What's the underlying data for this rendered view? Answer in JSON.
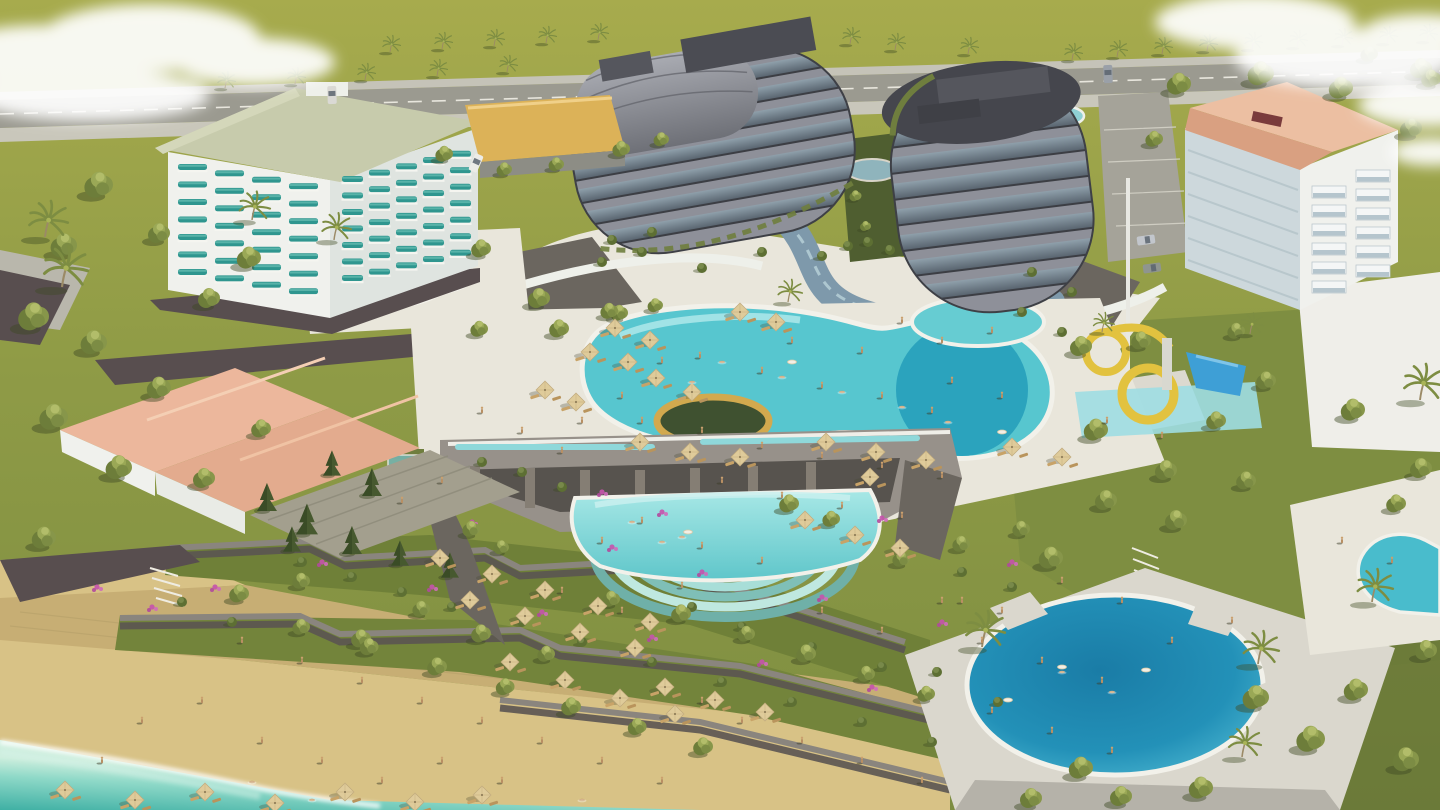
{
  "meta": {
    "title": "Aerial 3D architectural rendering of a seaside resort complex",
    "type": "architectural-visualization",
    "landmarks": [
      "white-hotel-teal-balconies",
      "curved-tower-west",
      "curved-tower-east",
      "salmon-roof-apartment",
      "salmon-roof-villa",
      "main-lagoon-pool",
      "kids-pool",
      "waterslides",
      "infinity-cascade-pool",
      "circular-pool",
      "kidney-pool",
      "right-edge-pool",
      "beach",
      "sea",
      "terraced-gardens",
      "palm-boulevard"
    ]
  },
  "colors": {
    "grass_far": "#a7ab4d",
    "grass_mid": "#8f9b46",
    "grass_near": "#7d8d41",
    "grass_shade": "#5e7034",
    "road": "#9b9a90",
    "sidewalk": "#c9c7bb",
    "parking": "#a5a399",
    "paving": "#e9e6db",
    "paving_shade": "#cfccc2",
    "deck": "#dad7cd",
    "sand": "#d8c286",
    "pavers": "#c7ae74",
    "sea_light": "#cdeedd",
    "sea_deep": "#3fb0a4",
    "foam": "#ffffff",
    "pool_main": "#57c6cf",
    "pool_deep": "#2ba3bd",
    "pool_light": "#8fd3e2",
    "pool_infinity": "#6fcdd0",
    "pool_round_deep": "#1a7ca6",
    "pool_round_edge": "#45b0cc",
    "lagoon": "#7e99ab",
    "wall_dark": "#584e4f",
    "wall_grey": "#8a857e",
    "stone": "#97918a",
    "stone_dark": "#6b665f",
    "white_bldg": "#f0f1ed",
    "white_shade": "#dfe4e0",
    "plaza": "#efeee9",
    "teal_balcony": "#2f968f",
    "roof_sage": "#c7cbac",
    "roof_salmon": "#e3ad8e",
    "roof_salmon_light": "#ecbfa2",
    "roof_salmon_dark": "#d9a081",
    "roof_shingle": "#a39f8e",
    "tower_band": "#8e9099",
    "tower_dark": "#45464d",
    "tower_glass_hi": "#8fa0ab",
    "tower_glass_lo": "#56616c",
    "slide_yellow": "#e2c23f",
    "slide_blue": "#3e9fd6",
    "umbrella": "#dfcb9a",
    "umbrella_edge": "#bfa97c",
    "lounger": "#c8a368",
    "tree_dark": "#6d7d3a",
    "tree_mid": "#87964a",
    "tree_light": "#9aa856",
    "pine": "#47592f",
    "palm_frond": "#7d8d42",
    "trunk": "#9b8a66",
    "bougainvillea": "#c653ad",
    "gold_ring": "#d2a94e",
    "yellow_roof": "#dcb258",
    "cloud": "#ffffff"
  },
  "scene": {
    "palms_far": [
      [
        225,
        88
      ],
      [
        295,
        84
      ],
      [
        365,
        80
      ],
      [
        437,
        76
      ],
      [
        507,
        72
      ],
      [
        390,
        52
      ],
      [
        442,
        49
      ],
      [
        494,
        46
      ],
      [
        546,
        43
      ],
      [
        598,
        40
      ],
      [
        850,
        44
      ],
      [
        895,
        50
      ],
      [
        968,
        54
      ],
      [
        1072,
        60
      ],
      [
        1117,
        57
      ],
      [
        1162,
        54
      ],
      [
        1207,
        51
      ],
      [
        1252,
        49
      ],
      [
        1297,
        47
      ],
      [
        1342,
        45
      ],
      [
        1387,
        43
      ],
      [
        1427,
        41
      ]
    ],
    "palms": [
      [
        45,
        237,
        1.2
      ],
      [
        252,
        220,
        0.95
      ],
      [
        334,
        240,
        0.9
      ],
      [
        62,
        287,
        1.35
      ],
      [
        982,
        647,
        1.2
      ],
      [
        1258,
        664,
        1.1
      ],
      [
        1242,
        757,
        1.0
      ],
      [
        1420,
        400,
        1.2
      ],
      [
        1372,
        602,
        1.1
      ],
      [
        788,
        302,
        0.75
      ],
      [
        1250,
        334,
        0.7
      ],
      [
        1102,
        332,
        0.65
      ]
    ],
    "trees": [
      [
        100,
        190,
        1.3
      ],
      [
        65,
        250,
        1.2
      ],
      [
        160,
        237,
        1.0
      ],
      [
        250,
        262,
        1.1
      ],
      [
        210,
        302,
        1.0
      ],
      [
        35,
        322,
        1.4
      ],
      [
        95,
        347,
        1.2
      ],
      [
        160,
        392,
        1.1
      ],
      [
        55,
        422,
        1.3
      ],
      [
        120,
        472,
        1.2
      ],
      [
        45,
        542,
        1.1
      ],
      [
        205,
        482,
        1.0
      ],
      [
        262,
        432,
        0.9
      ],
      [
        482,
        252,
        0.9
      ],
      [
        540,
        302,
        1.0
      ],
      [
        480,
        332,
        0.8
      ],
      [
        620,
        316,
        0.8
      ],
      [
        656,
        308,
        0.7
      ],
      [
        560,
        332,
        0.9
      ],
      [
        610,
        314,
        0.8
      ],
      [
        445,
        157,
        0.8
      ],
      [
        505,
        172,
        0.7
      ],
      [
        557,
        167,
        0.7
      ],
      [
        622,
        152,
        0.8
      ],
      [
        662,
        142,
        0.7
      ],
      [
        1180,
        88,
        1.1
      ],
      [
        1262,
        78,
        1.2
      ],
      [
        1342,
        92,
        1.1
      ],
      [
        1422,
        72,
        1.0
      ],
      [
        1370,
        57,
        0.8
      ],
      [
        1432,
        82,
        0.9
      ],
      [
        1412,
        132,
        1.0
      ],
      [
        1155,
        142,
        0.8
      ],
      [
        856,
        198,
        0.55
      ],
      [
        866,
        228,
        0.5
      ],
      [
        1082,
        350,
        1.0
      ],
      [
        1142,
        344,
        0.9
      ],
      [
        1097,
        434,
        1.1
      ],
      [
        1167,
        474,
        1.0
      ],
      [
        1217,
        424,
        0.9
      ],
      [
        1267,
        384,
        0.9
      ],
      [
        1237,
        334,
        0.8
      ],
      [
        1052,
        562,
        1.1
      ],
      [
        1107,
        504,
        1.0
      ],
      [
        1177,
        524,
        1.0
      ],
      [
        1247,
        484,
        0.9
      ],
      [
        1354,
        414,
        1.1
      ],
      [
        1422,
        472,
        1.0
      ],
      [
        1397,
        507,
        0.9
      ],
      [
        240,
        597,
        0.9
      ],
      [
        302,
        584,
        0.8
      ],
      [
        362,
        642,
        0.9
      ],
      [
        422,
        612,
        0.8
      ],
      [
        482,
        637,
        0.9
      ],
      [
        547,
        657,
        0.8
      ],
      [
        612,
        602,
        0.8
      ],
      [
        682,
        617,
        0.9
      ],
      [
        747,
        637,
        0.8
      ],
      [
        807,
        657,
        0.9
      ],
      [
        867,
        677,
        0.8
      ],
      [
        927,
        697,
        0.8
      ],
      [
        302,
        630,
        0.8
      ],
      [
        370,
        650,
        0.85
      ],
      [
        438,
        670,
        0.9
      ],
      [
        506,
        690,
        0.85
      ],
      [
        572,
        710,
        0.9
      ],
      [
        638,
        730,
        0.85
      ],
      [
        704,
        750,
        0.9
      ],
      [
        1257,
        702,
        1.2
      ],
      [
        1312,
        744,
        1.3
      ],
      [
        1357,
        694,
        1.1
      ],
      [
        1407,
        764,
        1.2
      ],
      [
        1427,
        654,
        1.0
      ],
      [
        1202,
        792,
        1.1
      ],
      [
        1122,
        800,
        1.0
      ],
      [
        1082,
        772,
        1.1
      ],
      [
        1032,
        802,
        1.0
      ],
      [
        790,
        507,
        0.9
      ],
      [
        832,
        522,
        0.8
      ],
      [
        472,
        532,
        0.8
      ],
      [
        502,
        550,
        0.7
      ],
      [
        902,
        562,
        0.8
      ],
      [
        962,
        547,
        0.8
      ],
      [
        1022,
        532,
        0.8
      ]
    ],
    "pines": [
      [
        267,
        507,
        1.0
      ],
      [
        307,
        530,
        1.1
      ],
      [
        352,
        550,
        1.0
      ],
      [
        400,
        562,
        0.9
      ],
      [
        450,
        574,
        0.9
      ],
      [
        332,
        472,
        0.9
      ],
      [
        372,
        492,
        1.0
      ],
      [
        292,
        548,
        0.9
      ]
    ],
    "bushes": [
      [
        937,
        672
      ],
      [
        998,
        702
      ],
      [
        868,
        242
      ],
      [
        822,
        256
      ],
      [
        762,
        252
      ],
      [
        702,
        268
      ],
      [
        642,
        252
      ],
      [
        602,
        262
      ],
      [
        1022,
        312
      ],
      [
        1062,
        332
      ],
      [
        482,
        462
      ],
      [
        522,
        472
      ],
      [
        562,
        487
      ],
      [
        302,
        562
      ],
      [
        352,
        577
      ],
      [
        402,
        592
      ],
      [
        452,
        607
      ],
      [
        522,
        622
      ],
      [
        582,
        642
      ],
      [
        652,
        662
      ],
      [
        722,
        682
      ],
      [
        792,
        702
      ],
      [
        862,
        722
      ],
      [
        932,
        742
      ],
      [
        232,
        622
      ],
      [
        182,
        602
      ],
      [
        962,
        572
      ],
      [
        1012,
        587
      ],
      [
        692,
        607
      ],
      [
        742,
        627
      ],
      [
        812,
        647
      ],
      [
        882,
        667
      ],
      [
        652,
        232
      ],
      [
        612,
        240
      ],
      [
        1032,
        272
      ],
      [
        1072,
        292
      ],
      [
        848,
        246
      ],
      [
        890,
        250
      ]
    ],
    "bougainvillea": [
      [
        215,
        587
      ],
      [
        322,
        562
      ],
      [
        432,
        587
      ],
      [
        542,
        612
      ],
      [
        652,
        637
      ],
      [
        762,
        662
      ],
      [
        872,
        687
      ],
      [
        472,
        522
      ],
      [
        612,
        547
      ],
      [
        702,
        572
      ],
      [
        822,
        597
      ],
      [
        942,
        622
      ],
      [
        97,
        587
      ],
      [
        152,
        607
      ],
      [
        602,
        492
      ],
      [
        662,
        512
      ],
      [
        1012,
        562
      ],
      [
        882,
        518
      ]
    ],
    "umbrellas": [
      [
        740,
        312
      ],
      [
        776,
        322
      ],
      [
        615,
        328
      ],
      [
        650,
        340
      ],
      [
        628,
        362
      ],
      [
        590,
        352
      ],
      [
        545,
        390
      ],
      [
        576,
        402
      ],
      [
        656,
        378
      ],
      [
        692,
        392
      ],
      [
        640,
        442
      ],
      [
        690,
        452
      ],
      [
        740,
        457
      ],
      [
        826,
        442
      ],
      [
        876,
        452
      ],
      [
        926,
        460
      ],
      [
        1012,
        447
      ],
      [
        1062,
        457
      ],
      [
        440,
        558
      ],
      [
        492,
        574
      ],
      [
        545,
        590
      ],
      [
        598,
        606
      ],
      [
        650,
        622
      ],
      [
        470,
        600
      ],
      [
        525,
        616
      ],
      [
        580,
        632
      ],
      [
        635,
        648
      ],
      [
        510,
        662
      ],
      [
        565,
        680
      ],
      [
        620,
        698
      ],
      [
        675,
        714
      ],
      [
        805,
        520
      ],
      [
        855,
        535
      ],
      [
        900,
        548
      ],
      [
        870,
        477
      ],
      [
        665,
        687
      ],
      [
        715,
        700
      ],
      [
        765,
        712
      ],
      [
        65,
        790
      ],
      [
        135,
        800
      ],
      [
        205,
        792
      ],
      [
        275,
        803
      ],
      [
        345,
        792
      ],
      [
        415,
        802
      ],
      [
        482,
        795
      ]
    ],
    "people": [
      [
        700,
        357
      ],
      [
        762,
        372
      ],
      [
        822,
        387
      ],
      [
        882,
        397
      ],
      [
        932,
        412
      ],
      [
        862,
        352
      ],
      [
        792,
        342
      ],
      [
        952,
        382
      ],
      [
        1002,
        397
      ],
      [
        662,
        362
      ],
      [
        622,
        397
      ],
      [
        582,
        422
      ],
      [
        642,
        422
      ],
      [
        702,
        432
      ],
      [
        762,
        447
      ],
      [
        822,
        457
      ],
      [
        882,
        467
      ],
      [
        942,
        477
      ],
      [
        562,
        452
      ],
      [
        522,
        432
      ],
      [
        482,
        412
      ],
      [
        942,
        342
      ],
      [
        992,
        332
      ],
      [
        902,
        322
      ],
      [
        1107,
        422
      ],
      [
        1162,
        437
      ],
      [
        722,
        482
      ],
      [
        782,
        497
      ],
      [
        842,
        507
      ],
      [
        902,
        517
      ],
      [
        642,
        522
      ],
      [
        602,
        542
      ],
      [
        702,
        547
      ],
      [
        762,
        562
      ],
      [
        682,
        587
      ],
      [
        622,
        612
      ],
      [
        562,
        592
      ],
      [
        822,
        612
      ],
      [
        882,
        632
      ],
      [
        942,
        602
      ],
      [
        1002,
        612
      ],
      [
        1062,
        582
      ],
      [
        1122,
        602
      ],
      [
        982,
        642
      ],
      [
        1042,
        662
      ],
      [
        242,
        642
      ],
      [
        302,
        662
      ],
      [
        362,
        682
      ],
      [
        422,
        702
      ],
      [
        482,
        722
      ],
      [
        542,
        742
      ],
      [
        602,
        762
      ],
      [
        662,
        782
      ],
      [
        202,
        702
      ],
      [
        142,
        722
      ],
      [
        262,
        742
      ],
      [
        322,
        762
      ],
      [
        382,
        782
      ],
      [
        102,
        762
      ],
      [
        442,
        762
      ],
      [
        502,
        782
      ],
      [
        702,
        702
      ],
      [
        742,
        722
      ],
      [
        802,
        742
      ],
      [
        862,
        762
      ],
      [
        922,
        782
      ],
      [
        992,
        712
      ],
      [
        1052,
        732
      ],
      [
        1112,
        752
      ],
      [
        1172,
        642
      ],
      [
        1232,
        622
      ],
      [
        962,
        602
      ],
      [
        442,
        482
      ],
      [
        402,
        502
      ],
      [
        1342,
        542
      ],
      [
        1392,
        562
      ],
      [
        1102,
        682
      ]
    ],
    "swimmers": [
      [
        722,
        362
      ],
      [
        782,
        377
      ],
      [
        842,
        392
      ],
      [
        902,
        407
      ],
      [
        948,
        422
      ],
      [
        692,
        382
      ],
      [
        632,
        522
      ],
      [
        682,
        537
      ],
      [
        1062,
        672
      ],
      [
        1112,
        692
      ],
      [
        662,
        542
      ],
      [
        252,
        782
      ],
      [
        312,
        800
      ],
      [
        582,
        800
      ]
    ],
    "floats": [
      [
        792,
        362
      ],
      [
        1002,
        432
      ],
      [
        1062,
        667
      ],
      [
        1146,
        670
      ],
      [
        1008,
        700
      ],
      [
        688,
        532
      ]
    ],
    "cars": [
      [
        332,
        95,
        -2,
        "#dad9d4"
      ],
      [
        1108,
        74,
        -2,
        "#9aa0a8"
      ],
      [
        476,
        163,
        24,
        "#ecece8"
      ],
      [
        1146,
        240,
        82,
        "#c2c6cc"
      ],
      [
        1152,
        268,
        82,
        "#8f958f"
      ]
    ],
    "hotel_balconies": {
      "left": {
        "x": 178,
        "y": 164,
        "cols": 4,
        "rows": 7,
        "dx": 37,
        "dy": 17.5,
        "w": 29,
        "colSlant": 6.4
      },
      "right": {
        "x": 342,
        "y": 176,
        "cols": 5,
        "rows": 7,
        "dx": 27,
        "dy": 16.5,
        "w": 21,
        "colSlant": -6.3
      }
    },
    "apt_balconies": {
      "x": 1312,
      "y": 186,
      "cols": 2,
      "rows": 6,
      "dx": 44,
      "dy": 19,
      "w": 34,
      "colSlant": -16
    }
  }
}
